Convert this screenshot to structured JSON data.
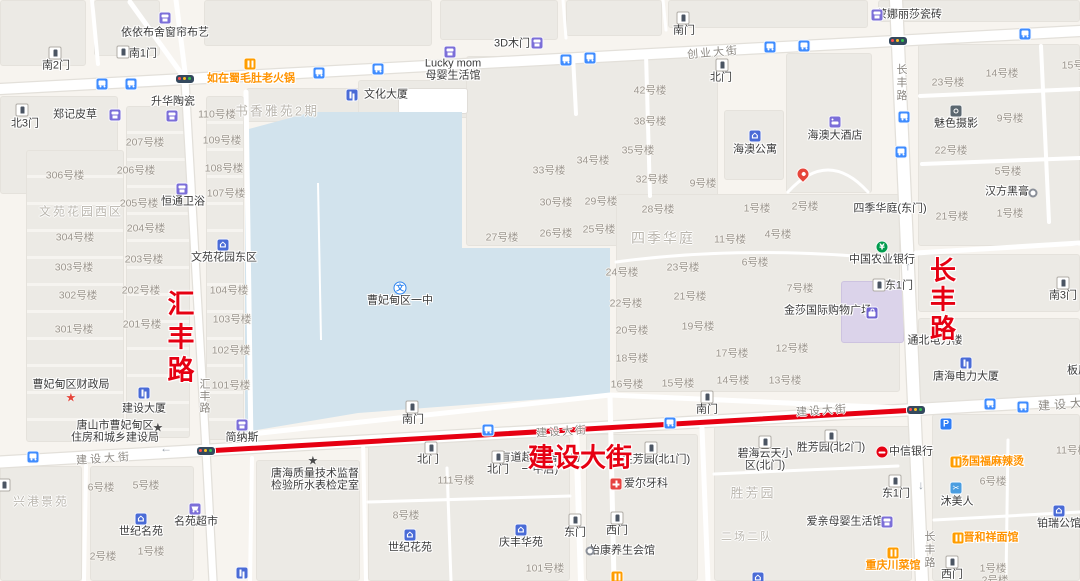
{
  "colors": {
    "land": "#f7f4ef",
    "block": "#eceae5",
    "water": "#d2e3ed",
    "road": "#ffffff",
    "casing": "#e3e0da",
    "route": "#e60012",
    "accent_red": "#e60012",
    "poi_orange": "#ff9300"
  },
  "water": {
    "points": "245,130 312,112 462,112 462,248 610,248 610,394 358,413 245,432",
    "pier": {
      "x1": 318,
      "y1": 183,
      "x2": 321,
      "y2": 340
    }
  },
  "roads": [
    {
      "d": "M0,89 L1080,31",
      "w": 10,
      "c": 1
    },
    {
      "d": "M0,462 L1080,400",
      "w": 11,
      "c": 1
    },
    {
      "d": "M896,0 L922,581",
      "w": 12,
      "c": 1
    },
    {
      "d": "M185,80 L206,450 L213,581",
      "w": 7,
      "c": 1
    },
    {
      "d": "M246,92 L251,447",
      "w": 5
    },
    {
      "d": "M251,434 L610,395 L897,408",
      "w": 5
    },
    {
      "d": "M576,426 L581,581",
      "w": 6
    },
    {
      "d": "M610,396 L614,581",
      "w": 5
    },
    {
      "d": "M573,56 L576,114",
      "w": 4
    },
    {
      "d": "M130,2 L186,80",
      "w": 5
    },
    {
      "d": "M186,80 L176,0",
      "w": 5
    },
    {
      "d": "M646,54 L650,196",
      "w": 4
    },
    {
      "d": "M916,253 L1080,243",
      "w": 5
    },
    {
      "d": "M86,466 L84,581",
      "w": 4
    },
    {
      "d": "M252,458 L250,581",
      "w": 4
    },
    {
      "d": "M363,440 L366,581",
      "w": 4
    },
    {
      "d": "M447,468 L451,581",
      "w": 3
    },
    {
      "d": "M368,502 L570,496",
      "w": 3
    },
    {
      "d": "M702,428 L708,581",
      "w": 5
    },
    {
      "d": "M1041,46 L1049,222",
      "w": 4
    },
    {
      "d": "M920,96 L1080,89",
      "w": 4
    },
    {
      "d": "M922,164 L1080,158",
      "w": 4
    },
    {
      "d": "M714,474 L898,466",
      "w": 3
    },
    {
      "d": "M934,520 L1080,512",
      "w": 3
    },
    {
      "d": "M1008,440 L1006,581",
      "w": 3
    },
    {
      "d": "M92,0 L98,64",
      "w": 4
    },
    {
      "d": "M563,0 L566,38",
      "w": 3
    },
    {
      "d": "M663,0 L666,30",
      "w": 3
    },
    {
      "d": "M616,262 Q750,244 898,260",
      "w": 3
    },
    {
      "d": "M788,192 Q828,148 868,192",
      "w": 3
    }
  ],
  "route": {
    "d": "M206,451 L916,410",
    "w": 5
  },
  "blocks": [
    {
      "x": 0,
      "y": 0,
      "w": 86,
      "h": 66
    },
    {
      "x": 94,
      "y": 0,
      "w": 66,
      "h": 56
    },
    {
      "x": 204,
      "y": 0,
      "w": 228,
      "h": 46
    },
    {
      "x": 440,
      "y": 0,
      "w": 118,
      "h": 40
    },
    {
      "x": 566,
      "y": 0,
      "w": 96,
      "h": 36
    },
    {
      "x": 668,
      "y": 0,
      "w": 200,
      "h": 28
    },
    {
      "x": 878,
      "y": 0,
      "w": 202,
      "h": 22
    },
    {
      "x": 0,
      "y": 96,
      "w": 118,
      "h": 98
    },
    {
      "x": 26,
      "y": 150,
      "w": 98,
      "h": 292,
      "cls": "rows"
    },
    {
      "x": 126,
      "y": 106,
      "w": 64,
      "h": 332,
      "cls": "rows"
    },
    {
      "x": 206,
      "y": 96,
      "w": 38,
      "h": 344,
      "cls": "rows"
    },
    {
      "x": 246,
      "y": 88,
      "w": 148,
      "h": 34
    },
    {
      "x": 358,
      "y": 80,
      "w": 112,
      "h": 38
    },
    {
      "x": 466,
      "y": 56,
      "w": 252,
      "h": 190
    },
    {
      "x": 616,
      "y": 194,
      "w": 284,
      "h": 198
    },
    {
      "x": 724,
      "y": 110,
      "w": 60,
      "h": 70
    },
    {
      "x": 786,
      "y": 53,
      "w": 86,
      "h": 140
    },
    {
      "x": 918,
      "y": 44,
      "w": 162,
      "h": 202
    },
    {
      "x": 918,
      "y": 254,
      "w": 162,
      "h": 58
    },
    {
      "x": 918,
      "y": 318,
      "w": 162,
      "h": 90
    },
    {
      "x": 0,
      "y": 466,
      "w": 82,
      "h": 115
    },
    {
      "x": 90,
      "y": 466,
      "w": 104,
      "h": 115
    },
    {
      "x": 256,
      "y": 460,
      "w": 104,
      "h": 121
    },
    {
      "x": 368,
      "y": 436,
      "w": 202,
      "h": 145
    },
    {
      "x": 586,
      "y": 434,
      "w": 112,
      "h": 147
    },
    {
      "x": 714,
      "y": 426,
      "w": 198,
      "h": 155
    },
    {
      "x": 932,
      "y": 414,
      "w": 148,
      "h": 167
    },
    {
      "x": 841,
      "y": 281,
      "w": 63,
      "h": 62,
      "cls": "purple"
    },
    {
      "x": 398,
      "y": 88,
      "w": 70,
      "h": 26,
      "cls": "white"
    }
  ],
  "bus_stops": [
    [
      102,
      84
    ],
    [
      131,
      84
    ],
    [
      319,
      73
    ],
    [
      378,
      69
    ],
    [
      566,
      60
    ],
    [
      590,
      58
    ],
    [
      770,
      47
    ],
    [
      804,
      46
    ],
    [
      1025,
      34
    ],
    [
      904,
      117
    ],
    [
      901,
      152
    ],
    [
      33,
      457
    ],
    [
      488,
      430
    ],
    [
      670,
      423
    ],
    [
      990,
      404
    ],
    [
      1023,
      407
    ]
  ],
  "traffic_lights": [
    [
      206,
      451
    ],
    [
      916,
      410
    ],
    [
      185,
      79
    ],
    [
      898,
      41
    ]
  ],
  "arrows": [
    {
      "g": "←",
      "x": 166,
      "y": 448
    },
    {
      "g": "↑",
      "x": 908,
      "y": 266
    },
    {
      "g": "↓",
      "x": 921,
      "y": 485
    }
  ],
  "misc_icons": [
    {
      "i": "pin",
      "x": 803,
      "y": 174,
      "name": "map-pin-icon"
    },
    {
      "i": "p",
      "x": 946,
      "y": 424,
      "name": "parking-icon"
    },
    {
      "i": "rest",
      "x": 617,
      "y": 577,
      "name": "restaurant-icon"
    },
    {
      "i": "bldg",
      "x": 242,
      "y": 573,
      "name": "building-icon"
    },
    {
      "i": "house",
      "x": 758,
      "y": 578,
      "name": "house-icon"
    },
    {
      "i": "gate",
      "x": 4,
      "y": 485,
      "name": "gate-icon"
    }
  ],
  "pois": [
    {
      "n": [
        "依依布舍窗帘布艺"
      ],
      "x": 165,
      "y": 33,
      "i": "shop",
      "ix": 165,
      "iy": 18
    },
    {
      "n": [
        "如在蜀毛肚老火锅"
      ],
      "x": 251,
      "y": 79,
      "i": "rest",
      "ix": 250,
      "iy": 64,
      "c": "o"
    },
    {
      "n": [
        "郑记皮草"
      ],
      "x": 75,
      "y": 115,
      "i": "shop",
      "ix": 115,
      "iy": 115
    },
    {
      "n": [
        "升华陶瓷"
      ],
      "x": 173,
      "y": 102,
      "i": "shop",
      "ix": 172,
      "iy": 116
    },
    {
      "n": [
        "恒通卫浴"
      ],
      "x": 183,
      "y": 202,
      "i": "shop",
      "ix": 182,
      "iy": 189
    },
    {
      "n": [
        "文化大厦"
      ],
      "x": 386,
      "y": 95,
      "i": "bldg",
      "ix": 352,
      "iy": 95
    },
    {
      "n": [
        "3D木门"
      ],
      "x": 512,
      "y": 44,
      "i": "shop",
      "ix": 537,
      "iy": 43
    },
    {
      "n": [
        "Lucky mom",
        "母婴生活馆"
      ],
      "x": 453,
      "y": 70,
      "i": "shop",
      "ix": 450,
      "iy": 52
    },
    {
      "n": [
        "蒙娜丽莎瓷砖"
      ],
      "x": 909,
      "y": 15,
      "i": "shop",
      "ix": 877,
      "iy": 15
    },
    {
      "n": [
        "海澳大酒店"
      ],
      "x": 835,
      "y": 136,
      "i": "bed",
      "ix": 835,
      "iy": 122
    },
    {
      "n": [
        "海澳公寓"
      ],
      "x": 755,
      "y": 150,
      "i": "house",
      "ix": 755,
      "iy": 136
    },
    {
      "n": [
        "魅色摄影"
      ],
      "x": 956,
      "y": 124,
      "i": "camera",
      "ix": 956,
      "iy": 111
    },
    {
      "n": [
        "汉方黑膏"
      ],
      "x": 1007,
      "y": 192,
      "i": "ring",
      "ix": 1033,
      "iy": 193
    },
    {
      "n": [
        "中国农业银行"
      ],
      "x": 882,
      "y": 260,
      "i": "bankg",
      "ix": 882,
      "iy": 247
    },
    {
      "n": [
        "四季华庭(东门)"
      ],
      "x": 890,
      "y": 209
    },
    {
      "n": [
        "金莎国际购物广场"
      ],
      "x": 828,
      "y": 311,
      "i": "bag",
      "ix": 872,
      "iy": 313
    },
    {
      "n": [
        "曹妃甸区一中"
      ],
      "x": 400,
      "y": 301,
      "i": "school",
      "ix": 400,
      "iy": 288
    },
    {
      "n": [
        "文苑花园东区"
      ],
      "x": 224,
      "y": 258,
      "i": "house",
      "ix": 223,
      "iy": 245
    },
    {
      "n": [
        "通北电力楼"
      ],
      "x": 935,
      "y": 341
    },
    {
      "n": [
        "板厂"
      ],
      "x": 1078,
      "y": 371
    },
    {
      "n": [
        "唐海电力大厦"
      ],
      "x": 966,
      "y": 377,
      "i": "bldg",
      "ix": 966,
      "iy": 363
    },
    {
      "n": [
        "曹妃甸区财政局"
      ],
      "x": 71,
      "y": 385,
      "i": "star red",
      "ix": 73,
      "iy": 398
    },
    {
      "n": [
        "建设大厦"
      ],
      "x": 144,
      "y": 409,
      "i": "bldg",
      "ix": 144,
      "iy": 393
    },
    {
      "n": [
        "唐山市曹妃甸区",
        "住房和城乡建设局"
      ],
      "x": 115,
      "y": 432,
      "i": "star dark",
      "ix": 160,
      "iy": 428
    },
    {
      "n": [
        "简纳斯"
      ],
      "x": 242,
      "y": 438,
      "i": "shop",
      "ix": 242,
      "iy": 425
    },
    {
      "n": [
        "唐海质量技术监督",
        "检验所水表检定室"
      ],
      "x": 315,
      "y": 480,
      "i": "star dark",
      "ix": 315,
      "iy": 461
    },
    {
      "n": [
        "名苑超市"
      ],
      "x": 196,
      "y": 522,
      "i": "cart",
      "ix": 195,
      "iy": 509
    },
    {
      "n": [
        "世纪名苑"
      ],
      "x": 141,
      "y": 532,
      "i": "house",
      "ix": 141,
      "iy": 519
    },
    {
      "n": [
        "世纪花苑"
      ],
      "x": 410,
      "y": 548,
      "i": "house",
      "ix": 410,
      "iy": 535
    },
    {
      "n": [
        "庆丰华苑"
      ],
      "x": 521,
      "y": 543,
      "i": "house",
      "ix": 521,
      "iy": 530
    },
    {
      "n": [
        "怡康养生会馆"
      ],
      "x": 622,
      "y": 551,
      "i": "ring",
      "ix": 590,
      "iy": 551
    },
    {
      "n": [
        "爱尔牙科"
      ],
      "x": 646,
      "y": 484,
      "i": "med",
      "ix": 616,
      "iy": 484
    },
    {
      "n": [
        "有道超市(曹妃甸",
        "一中店)"
      ],
      "x": 540,
      "y": 464
    },
    {
      "n": [
        "爱亲母婴生活馆"
      ],
      "x": 845,
      "y": 522,
      "i": "shop",
      "ix": 887,
      "iy": 522
    },
    {
      "n": [
        "中信银行"
      ],
      "x": 911,
      "y": 452,
      "i": "bankr",
      "ix": 882,
      "iy": 452
    },
    {
      "n": [
        "杨国福麻辣烫"
      ],
      "x": 991,
      "y": 462,
      "i": "rest",
      "ix": 956,
      "iy": 462,
      "c": "o"
    },
    {
      "n": [
        "沐美人"
      ],
      "x": 957,
      "y": 502,
      "i": "scissors",
      "ix": 956,
      "iy": 488
    },
    {
      "n": [
        "晋和祥面馆"
      ],
      "x": 991,
      "y": 538,
      "i": "rest",
      "ix": 958,
      "iy": 538,
      "c": "o"
    },
    {
      "n": [
        "重庆川菜馆"
      ],
      "x": 893,
      "y": 566,
      "i": "rest",
      "ix": 893,
      "iy": 553,
      "c": "o"
    },
    {
      "n": [
        "铂瑞公馆"
      ],
      "x": 1059,
      "y": 524,
      "i": "house",
      "ix": 1059,
      "iy": 511
    },
    {
      "n": [
        "南2门"
      ],
      "x": 56,
      "y": 66,
      "i": "gate",
      "ix": 55,
      "iy": 53
    },
    {
      "n": [
        "南1门"
      ],
      "x": 143,
      "y": 54,
      "i": "gate",
      "ix": 123,
      "iy": 52
    },
    {
      "n": [
        "北3门"
      ],
      "x": 25,
      "y": 124,
      "i": "gate",
      "ix": 22,
      "iy": 110
    },
    {
      "n": [
        "南门"
      ],
      "x": 684,
      "y": 31,
      "i": "gate",
      "ix": 683,
      "iy": 18
    },
    {
      "n": [
        "北门"
      ],
      "x": 721,
      "y": 78,
      "i": "gate",
      "ix": 722,
      "iy": 65
    },
    {
      "n": [
        "南3门"
      ],
      "x": 1063,
      "y": 296,
      "i": "gate",
      "ix": 1063,
      "iy": 283
    },
    {
      "n": [
        "东1门"
      ],
      "x": 899,
      "y": 286,
      "i": "gate",
      "ix": 879,
      "iy": 285
    },
    {
      "n": [
        "南门"
      ],
      "x": 413,
      "y": 420,
      "i": "gate",
      "ix": 412,
      "iy": 407
    },
    {
      "n": [
        "南门"
      ],
      "x": 707,
      "y": 410,
      "i": "gate",
      "ix": 707,
      "iy": 397
    },
    {
      "n": [
        "北门"
      ],
      "x": 428,
      "y": 460,
      "i": "gate",
      "ix": 431,
      "iy": 448
    },
    {
      "n": [
        "北门"
      ],
      "x": 498,
      "y": 470,
      "i": "gate",
      "ix": 498,
      "iy": 457
    },
    {
      "n": [
        "胜芳园(北1门)"
      ],
      "x": 656,
      "y": 460,
      "i": "gate",
      "ix": 651,
      "iy": 448
    },
    {
      "n": [
        "胜芳园(北2门)"
      ],
      "x": 831,
      "y": 448,
      "i": "gate",
      "ix": 831,
      "iy": 436
    },
    {
      "n": [
        "碧海云天小",
        "区(北门)"
      ],
      "x": 765,
      "y": 460,
      "i": "gate",
      "ix": 765,
      "iy": 442
    },
    {
      "n": [
        "东1门"
      ],
      "x": 896,
      "y": 494,
      "i": "gate",
      "ix": 895,
      "iy": 481
    },
    {
      "n": [
        "东门"
      ],
      "x": 575,
      "y": 533,
      "i": "gate",
      "ix": 575,
      "iy": 520
    },
    {
      "n": [
        "西门"
      ],
      "x": 617,
      "y": 531,
      "i": "gate",
      "ix": 617,
      "iy": 518
    },
    {
      "n": [
        "西门"
      ],
      "x": 952,
      "y": 575,
      "i": "gate",
      "ix": 952,
      "iy": 562
    }
  ],
  "unit_labels": [
    [
      "110号楼",
      217,
      114
    ],
    [
      "109号楼",
      222,
      140
    ],
    [
      "207号楼",
      145,
      142
    ],
    [
      "206号楼",
      136,
      170
    ],
    [
      "306号楼",
      65,
      175
    ],
    [
      "108号楼",
      224,
      168
    ],
    [
      "107号楼",
      226,
      193
    ],
    [
      "205号楼",
      139,
      203
    ],
    [
      "204号楼",
      146,
      228
    ],
    [
      "304号楼",
      75,
      237
    ],
    [
      "203号楼",
      144,
      259
    ],
    [
      "303号楼",
      74,
      267
    ],
    [
      "302号楼",
      78,
      295
    ],
    [
      "202号楼",
      141,
      290
    ],
    [
      "104号楼",
      229,
      290
    ],
    [
      "103号楼",
      232,
      319
    ],
    [
      "301号楼",
      74,
      329
    ],
    [
      "201号楼",
      142,
      324
    ],
    [
      "102号楼",
      231,
      350
    ],
    [
      "101号楼",
      231,
      385
    ],
    [
      "42号楼",
      650,
      90
    ],
    [
      "38号楼",
      650,
      121
    ],
    [
      "35号楼",
      638,
      150
    ],
    [
      "34号楼",
      593,
      160
    ],
    [
      "33号楼",
      549,
      170
    ],
    [
      "32号楼",
      652,
      179
    ],
    [
      "9号楼",
      703,
      183
    ],
    [
      "30号楼",
      556,
      202
    ],
    [
      "29号楼",
      601,
      201
    ],
    [
      "28号楼",
      658,
      209
    ],
    [
      "27号楼",
      502,
      237
    ],
    [
      "26号楼",
      556,
      233
    ],
    [
      "25号楼",
      599,
      229
    ],
    [
      "24号楼",
      622,
      272
    ],
    [
      "23号楼",
      683,
      267
    ],
    [
      "22号楼",
      626,
      303
    ],
    [
      "21号楼",
      690,
      296
    ],
    [
      "20号楼",
      632,
      330
    ],
    [
      "19号楼",
      698,
      326
    ],
    [
      "18号楼",
      632,
      358
    ],
    [
      "16号楼",
      627,
      384
    ],
    [
      "15号楼",
      678,
      383
    ],
    [
      "23号楼",
      948,
      82
    ],
    [
      "14号楼",
      1002,
      73
    ],
    [
      "15号楼",
      1078,
      65
    ],
    [
      "9号楼",
      1010,
      118
    ],
    [
      "22号楼",
      951,
      150
    ],
    [
      "5号楼",
      1008,
      171
    ],
    [
      "21号楼",
      952,
      216
    ],
    [
      "1号楼",
      1010,
      213
    ],
    [
      "1号楼",
      757,
      208
    ],
    [
      "2号楼",
      805,
      206
    ],
    [
      "11号楼",
      730,
      239
    ],
    [
      "4号楼",
      778,
      234
    ],
    [
      "6号楼",
      755,
      262
    ],
    [
      "7号楼",
      800,
      288
    ],
    [
      "12号楼",
      792,
      348
    ],
    [
      "17号楼",
      732,
      353
    ],
    [
      "14号楼",
      733,
      380
    ],
    [
      "13号楼",
      785,
      380
    ],
    [
      "111号楼",
      456,
      480
    ],
    [
      "8号楼",
      406,
      515
    ],
    [
      "101号楼",
      545,
      568
    ],
    [
      "6号楼",
      101,
      487
    ],
    [
      "5号楼",
      146,
      485
    ],
    [
      "1号楼",
      151,
      551
    ],
    [
      "2号楼",
      103,
      556
    ],
    [
      "6号楼",
      993,
      481
    ],
    [
      "1号楼",
      993,
      568
    ],
    [
      "2号楼",
      995,
      580
    ],
    [
      "11号楼",
      1072,
      450
    ]
  ],
  "area_labels": [
    {
      "t": "文苑花园西区",
      "x": 81,
      "y": 211,
      "s": 12
    },
    {
      "t": "书香雅苑2期",
      "x": 277,
      "y": 110,
      "s": 13
    },
    {
      "t": "四季华庭",
      "x": 663,
      "y": 238,
      "s": 14
    },
    {
      "t": "胜芳园",
      "x": 753,
      "y": 492,
      "s": 13
    },
    {
      "t": "兴港景苑",
      "x": 41,
      "y": 501,
      "s": 12
    },
    {
      "t": "二场二队",
      "x": 747,
      "y": 536,
      "s": 11
    }
  ],
  "road_labels": [
    {
      "t": "创业大街",
      "x": 713,
      "y": 52,
      "r": -5,
      "ls": 2
    },
    {
      "t": "建设大街",
      "x": 104,
      "y": 458,
      "r": -4,
      "ls": 3
    },
    {
      "t": "建设大街",
      "x": 562,
      "y": 431,
      "r": -4,
      "ls": 2
    },
    {
      "t": "建设大街",
      "x": 822,
      "y": 410,
      "r": -4,
      "ls": 2
    },
    {
      "t": "建设大",
      "x": 1062,
      "y": 404,
      "r": -4,
      "ls": 4,
      "s": 12
    },
    {
      "t": "长丰路",
      "x": 901,
      "y": 83,
      "v": 1,
      "ls": 2
    },
    {
      "t": "长丰路",
      "x": 929,
      "y": 550,
      "v": 1,
      "ls": 2
    },
    {
      "t": "汇丰路",
      "x": 204,
      "y": 396,
      "v": 1,
      "ls": 1
    }
  ],
  "red_labels": [
    {
      "t": "汇丰路",
      "x": 178,
      "y": 339,
      "v": 1,
      "s": 27,
      "ls": 6
    },
    {
      "t": "长丰路",
      "x": 941,
      "y": 300,
      "v": 1,
      "s": 26,
      "ls": 3
    },
    {
      "t": "建设大街",
      "x": 580,
      "y": 456,
      "v": 0,
      "s": 26,
      "ls": 0
    }
  ]
}
